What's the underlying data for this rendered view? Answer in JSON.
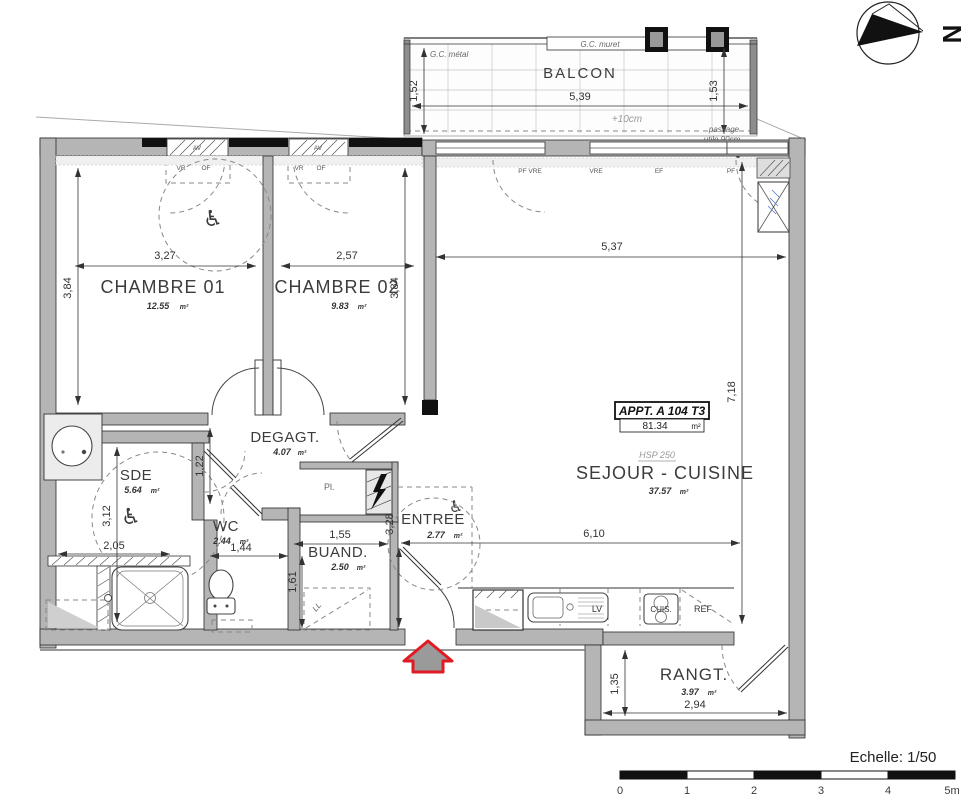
{
  "apartment": {
    "label": "APPT. A 104 T3",
    "area": "81.34",
    "unit": "m²",
    "hsp": "HSP 250"
  },
  "rooms": {
    "balcon": {
      "name": "BALCON"
    },
    "chambre1": {
      "name": "CHAMBRE 01",
      "area": "12.55",
      "unit": "m²"
    },
    "chambre2": {
      "name": "CHAMBRE 02",
      "area": "9.83",
      "unit": "m²"
    },
    "sejour": {
      "name": "SEJOUR - CUISINE",
      "area": "37.57",
      "unit": "m²"
    },
    "degagt": {
      "name": "DEGAGT.",
      "area": "4.07",
      "unit": "m²"
    },
    "sde": {
      "name": "SDE",
      "area": "5.64",
      "unit": "m²"
    },
    "wc": {
      "name": "WC",
      "area": "2.44",
      "unit": "m²"
    },
    "buand": {
      "name": "BUAND.",
      "area": "2.50",
      "unit": "m²"
    },
    "entree": {
      "name": "ENTREE",
      "area": "2.77",
      "unit": "m²"
    },
    "rangt": {
      "name": "RANGT.",
      "area": "3.97",
      "unit": "m²"
    }
  },
  "dims": {
    "balcon_w": "5,39",
    "balcon_l": "1,52",
    "balcon_r": "1,53",
    "ch1_w": "3,27",
    "ch2_w": "2,57",
    "sej_w": "5,37",
    "ch1_h": "3,84",
    "ch2_h": "3,84",
    "sej_h": "7,18",
    "sej_mid": "6,10",
    "deg_h": "1,22",
    "sde_h": "3,12",
    "sde_w": "2,05",
    "wc_w": "1,44",
    "buand_w": "1,55",
    "buand_h": "1,61",
    "entree_h": "3,28",
    "rangt_h": "1,35",
    "rangt_w": "2,94"
  },
  "annotations": {
    "gc_metal": "G.C. métal",
    "gc_muret": "G.C. muret",
    "plus10": "+10cm",
    "passage1": "passage",
    "passage2": "utile 90cm",
    "av1": "AV",
    "av2": "AV",
    "vr1": "VR",
    "of1": "OF",
    "vr2": "VR",
    "of2": "OF",
    "pf_vre": "PF  VRE",
    "vre": "VRE",
    "ef": "EF",
    "pf": "PF",
    "placard": "Pl.",
    "lave_linge": "LL",
    "lave_vaisselle": "LV",
    "cuisiniere": "CUIS.",
    "refrigerateur": "REF"
  },
  "symbols": {
    "wheelchair": "♿"
  },
  "north": {
    "label": "N"
  },
  "scalebar": {
    "label": "Echelle: 1/50",
    "ticks": [
      "0",
      "1",
      "2",
      "3",
      "4",
      "5m"
    ]
  },
  "colors": {
    "accent_pink": "#f23d7b",
    "accent_red": "#e01b24",
    "wall_gray": "#b5b5b5"
  }
}
